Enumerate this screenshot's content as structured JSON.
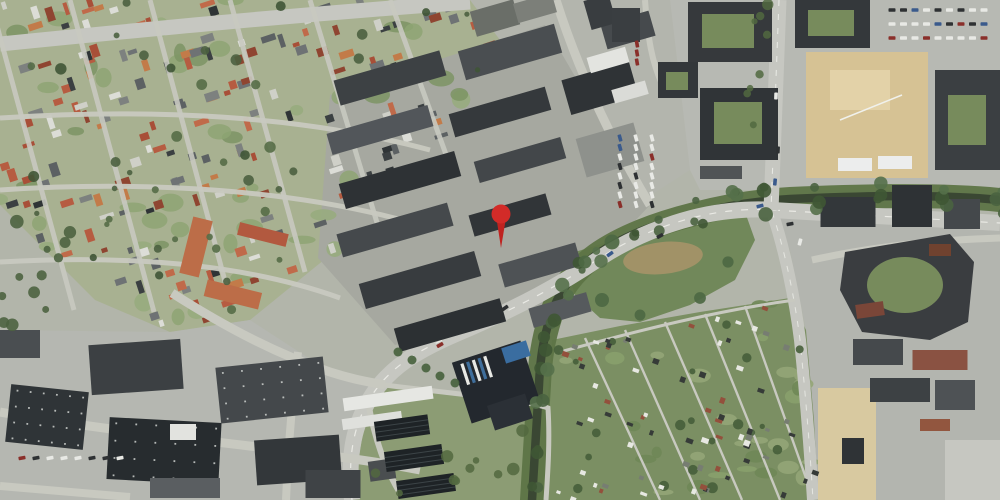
{
  "map": {
    "kind": "satellite-aerial-view",
    "marker": {
      "x": 501,
      "y": 214,
      "head_radius": 9.5,
      "tip_y": 248,
      "color": "#d22b28",
      "stroke": "#8f1b18",
      "stem_color": "#bf2320"
    }
  },
  "palette": {
    "base": "#b2b5aa",
    "residential_ground": "#a8b191",
    "industrial_ground_top": "#b3b5ad",
    "industrial_ground_mid": "#a6a8a0",
    "industrial_ground_bl": "#b5b7b1",
    "urban_ground_tr": "#b7b9b3",
    "urban_ground_rm": "#b3b5af",
    "meadow": "#71885a",
    "allotment": "#7b8f63",
    "treatment_green": "#8c9c74",
    "road": "#c6c7c1",
    "road_minor": "#c8c9c0",
    "road_line": "#f2f3ee",
    "water": "#3a4733",
    "corridor_green": "#5d7446",
    "building_dark": "#34383b",
    "building_mid": "#55595c",
    "roof_white": "#e4e5e1",
    "roof_red": "#b2593f",
    "roof_orange": "#bc6d48",
    "construction": "#d6c294",
    "courtyard_green": "#778b5c",
    "brown_patch": "#a69468",
    "tree_dark": "#4b6140"
  }
}
